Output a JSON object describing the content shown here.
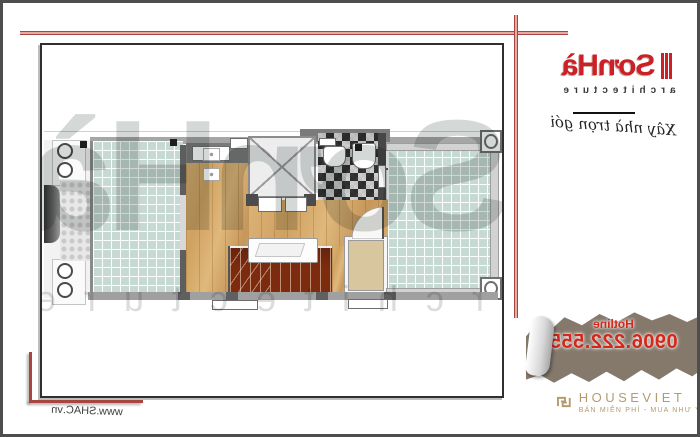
{
  "colors": {
    "accent-red": "#a8453e",
    "logo-red": "#cb2026",
    "hotline-red": "#d2291c",
    "torn-brown": "#85796c",
    "gold": "#b59a6d",
    "tile-green": "#c6d9d2",
    "wood": "#d2a361",
    "stair-brown": "#7c2b0f"
  },
  "sonha": {
    "logo": "SơnHà",
    "sub": "architecture",
    "tagline": "Xây nhà trọn gói"
  },
  "hotline": {
    "label": "Hotline",
    "number": "0906.222.555"
  },
  "houseviet": {
    "name": "HOUSEVIET",
    "tagline": "BÁN MIỄN PHÍ - MUA NHƯ Ý"
  },
  "watermark": {
    "big": "SơnHà",
    "small": "architecture"
  },
  "footer": {
    "website": "www.SHAC.vn"
  }
}
